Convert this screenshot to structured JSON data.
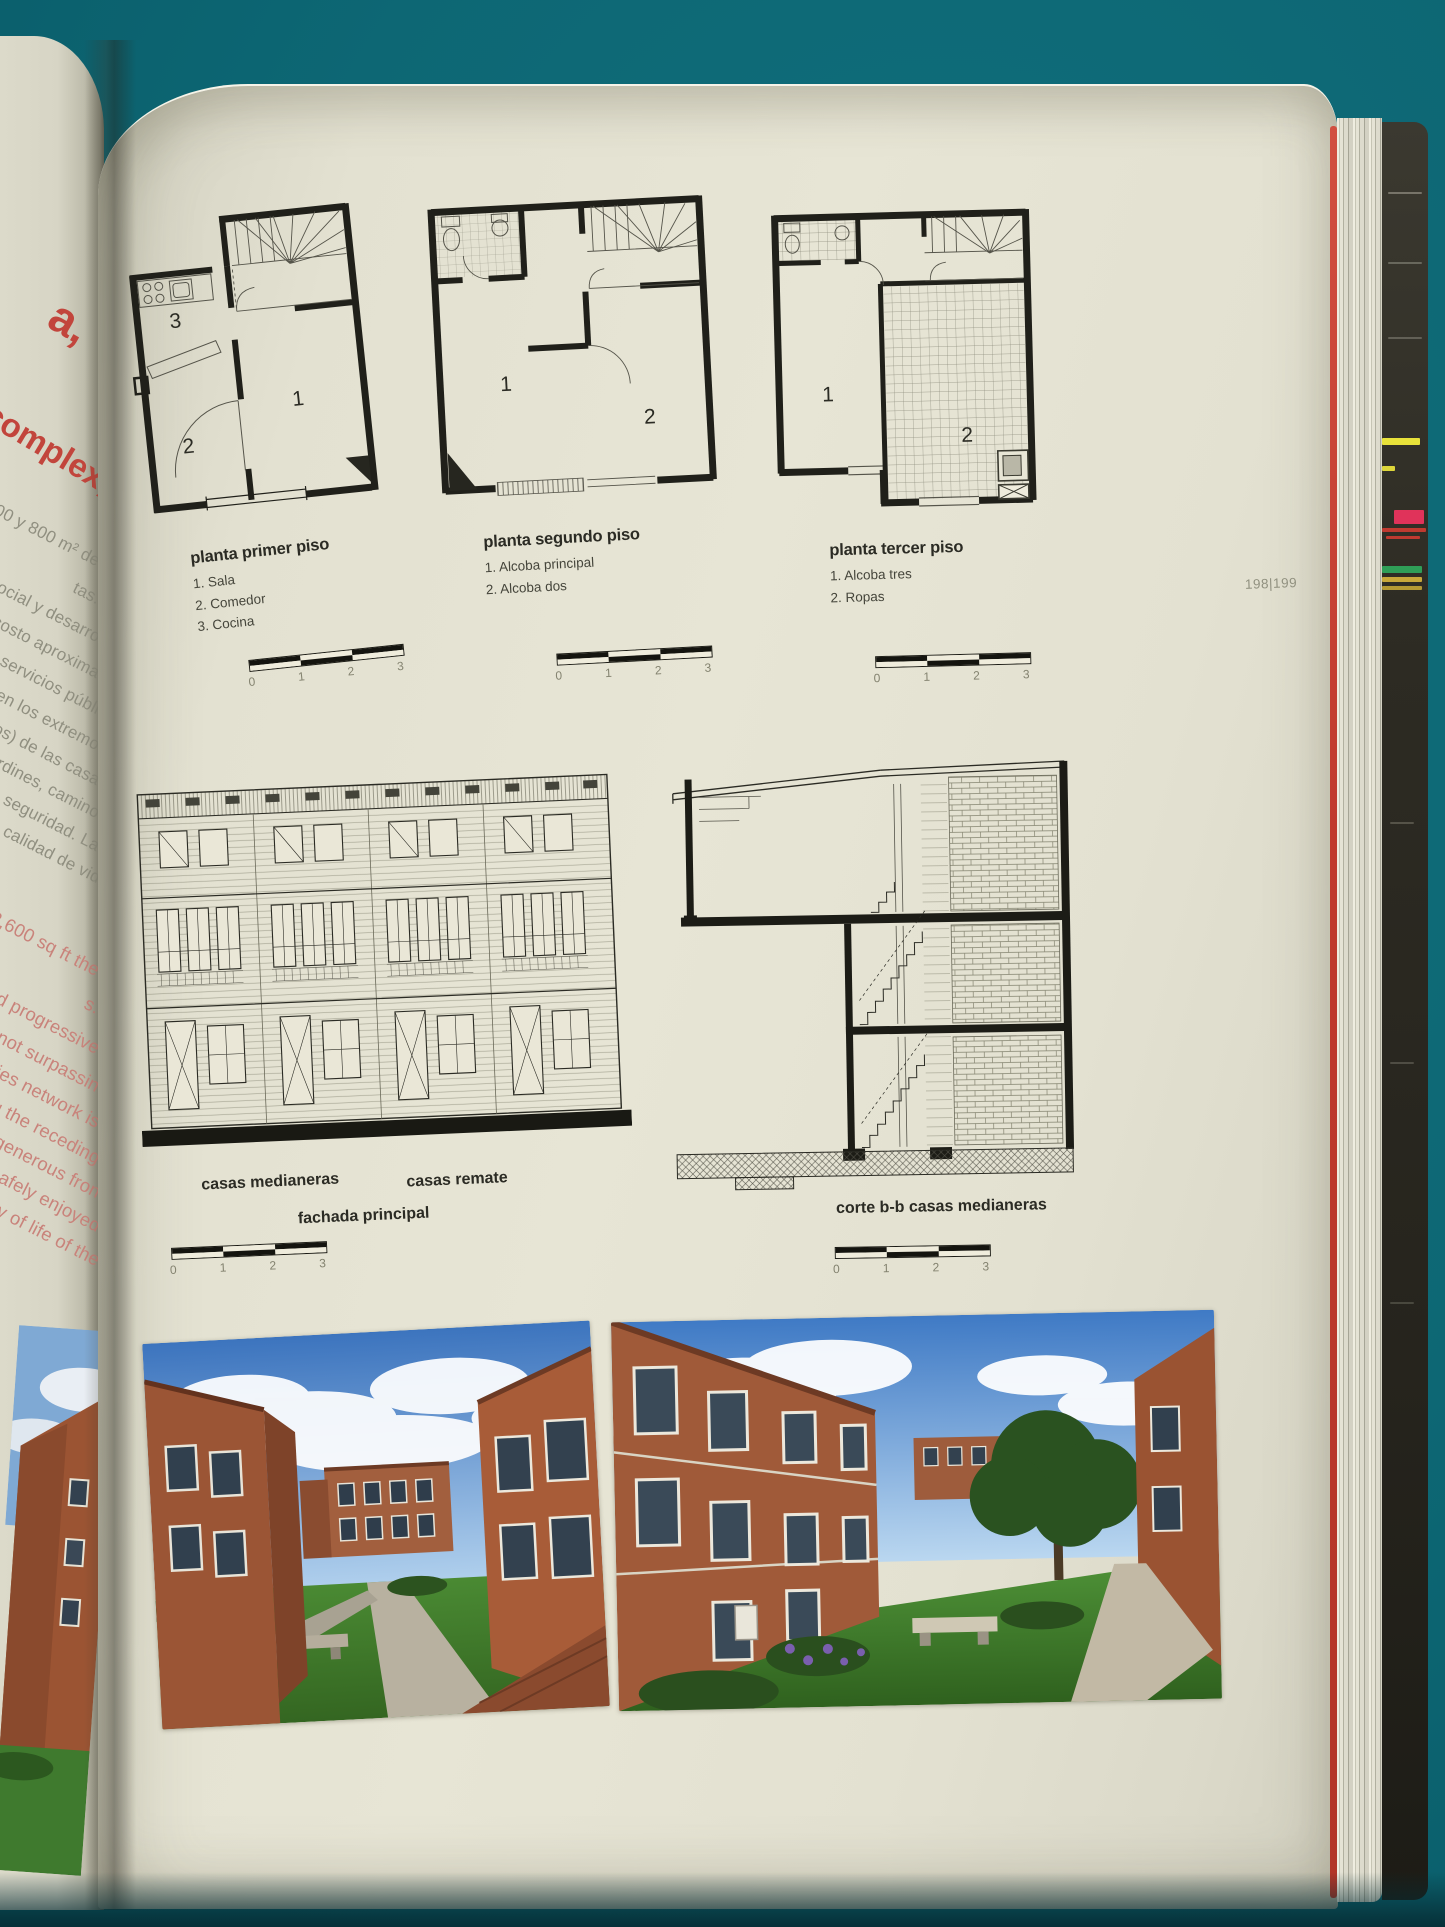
{
  "page_header": {
    "page_number": "198|199"
  },
  "plans": {
    "first": {
      "title": "planta primer piso",
      "legend": [
        "1. Sala",
        "2. Comedor",
        "3. Cocina"
      ],
      "rooms": {
        "r1": "1",
        "r2": "2",
        "r3": "3"
      }
    },
    "second": {
      "title": "planta segundo piso",
      "legend": [
        "1. Alcoba principal",
        "2. Alcoba dos"
      ],
      "rooms": {
        "r1": "1",
        "r2": "2"
      }
    },
    "third": {
      "title": "planta tercer piso",
      "legend": [
        "1. Alcoba tres",
        "2. Ropas"
      ],
      "rooms": {
        "r1": "1",
        "r2": "2"
      }
    }
  },
  "scale_bar": {
    "ticks": [
      "0",
      "1",
      "2",
      "3"
    ]
  },
  "elevation": {
    "label_left": "casas medianeras",
    "label_right": "casas remate",
    "caption": "fachada principal"
  },
  "section": {
    "caption": "corte b-b casas medianeras"
  },
  "left_page": {
    "fragment_big": "a,",
    "fragment_title": "complex,",
    "gray_lines": [
      "500 y 800 m² de",
      "tas.",
      "social y desarro",
      "n costo aproxima",
      "de servicios públi",
      "os en los extremo",
      "etiros) de las casa",
      "ejardines, camino",
      "con seguridad. La",
      "la calidad de vid"
    ],
    "pink_lines": [
      "nd 2,600 sq ft the",
      "s.",
      "and progressive",
      "d 2, not surpassin",
      "utilities network is",
      "eing the receding",
      "ain generous fron",
      "be safely enjoyed",
      "quality of life of the"
    ]
  },
  "colors": {
    "background": "#0d6774",
    "page": "#e5e3d3",
    "accent_red": "#c03a2d"
  }
}
